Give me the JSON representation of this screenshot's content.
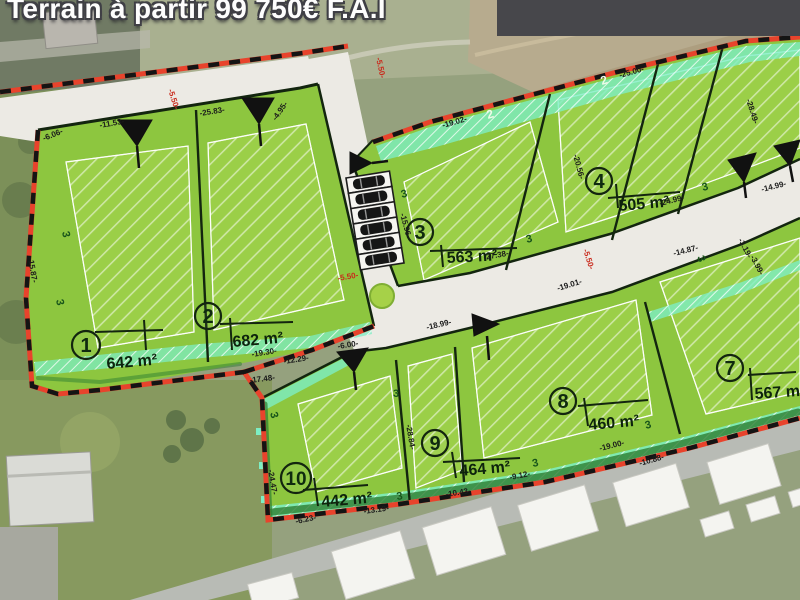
{
  "banner": {
    "text": "Terrain à partir 99 750€ F.A.I",
    "bg_color": "#47474b"
  },
  "parcels": [
    {
      "number": "1",
      "area": "642 m²"
    },
    {
      "number": "2",
      "area": "682 m²"
    },
    {
      "number": "3",
      "area": "563 m²"
    },
    {
      "number": "4",
      "area": "505 m²"
    },
    {
      "number": "7",
      "area": "567 m²"
    },
    {
      "number": "8",
      "area": "460 m²"
    },
    {
      "number": "9",
      "area": "464 m²"
    },
    {
      "number": "10",
      "area": "442 m²"
    }
  ],
  "zone_labels": {
    "zone2": "2",
    "zone3": "3"
  },
  "road_width_label": "-5.50-",
  "dimensions": [
    "-11.53-",
    "-25.83-",
    "-6.06-",
    "-4.95-",
    "-19.02-",
    "-25.00-",
    "-28.49-",
    "-20.56-",
    "-24.99-",
    "-14.87-",
    "-3.19-",
    "-3.99-",
    "-15.96-",
    "-27.38-",
    "-19.01-",
    "-18.99-",
    "-19.30-",
    "-12.29-",
    "-17.48-",
    "-24.47-",
    "-6.23-",
    "-13.19-",
    "-10.43-",
    "-9.12-",
    "-19.00-",
    "-10.88-",
    "-28.84-",
    "-6.00-",
    "-15.87-",
    "-14.99-"
  ],
  "colors": {
    "parcel_green": "#8dc63f",
    "hatch_green": "#9bcf48",
    "mint_strip": "#7deec4",
    "boundary_red": "#e8432c",
    "road_gray": "#eceae4",
    "banner_gray": "#47474b"
  }
}
